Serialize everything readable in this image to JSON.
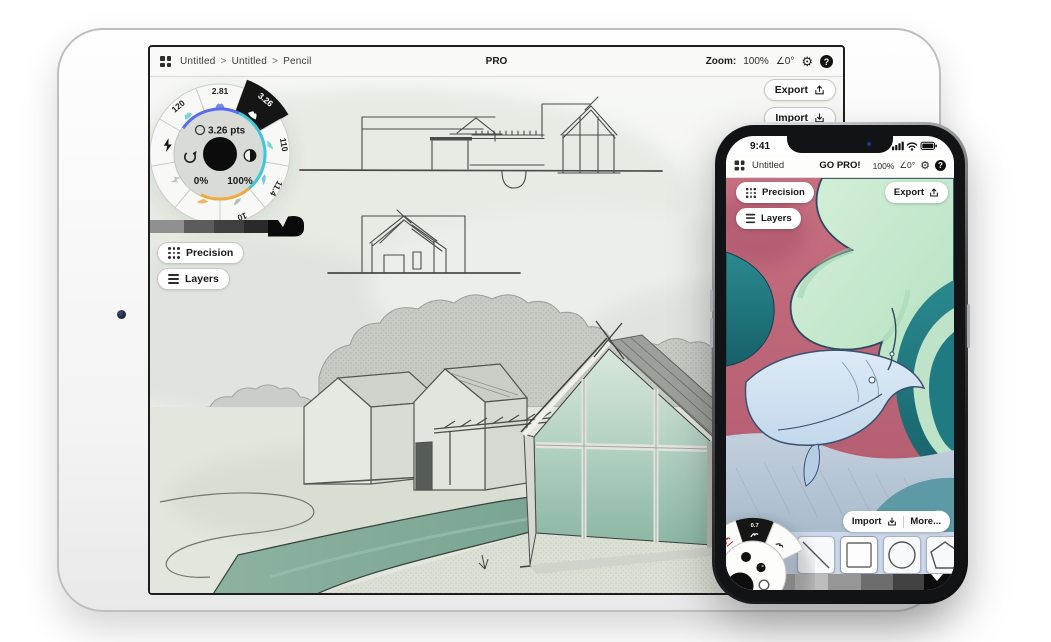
{
  "ipad": {
    "toolbar": {
      "breadcrumb": [
        "Untitled",
        "Untitled",
        "Pencil"
      ],
      "separator": ">",
      "pro_badge": "PRO",
      "zoom_label": "Zoom:",
      "zoom_value": "100%",
      "angle_value": "∠0°"
    },
    "actions": {
      "export": "Export",
      "import": "Import"
    },
    "wheel": {
      "segments": [
        "120",
        "2.81",
        "3.26",
        "110",
        "11.4",
        "10"
      ],
      "size_value": "3.26 pts",
      "opacity_left": "0%",
      "opacity_right": "100%"
    },
    "panels": {
      "precision": "Precision",
      "layers": "Layers"
    }
  },
  "iphone": {
    "status": {
      "time": "9:41"
    },
    "toolbar": {
      "title": "Untitled",
      "pro_badge": "GO PRO!",
      "zoom_value": "100%",
      "angle_value": "∠0°"
    },
    "overlays": {
      "precision": "Precision",
      "layers": "Layers",
      "export": "Export",
      "import": "Import",
      "more": "More..."
    },
    "wheel": {
      "segments": [
        "0.2",
        "0.7"
      ]
    }
  },
  "icons": {
    "gear": "⚙",
    "help": "?"
  },
  "colors": {
    "accent_blue": "#5a6cf0",
    "accent_cyan": "#3fc6d8",
    "accent_orange": "#f2a93c",
    "water_teal": "#7ca795",
    "art_pink": "#bd6577",
    "art_mint": "#c5e8cd",
    "art_teal": "#1f7a82",
    "whale_blue": "#cfe2f1",
    "shelf_blue": "#ccd8eb"
  }
}
